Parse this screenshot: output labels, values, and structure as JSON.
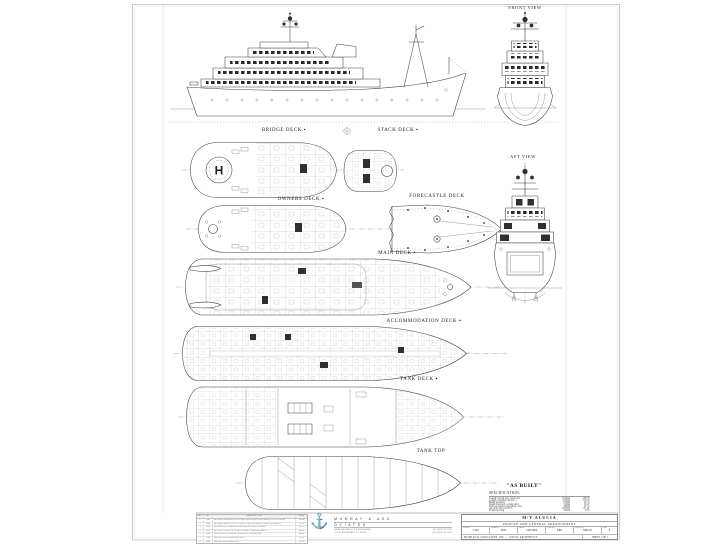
{
  "sheet": {
    "labels": {
      "front_view": "FRONT VIEW",
      "aft_view": "AFT VIEW",
      "bridge_deck": "BRIDGE DECK ▪",
      "stack_deck": "STACK DECK ▪",
      "owners_deck": "OWNERS DECK ▪",
      "forecastle_deck": "FORECASTLE DECK",
      "main_deck": "MAIN DECK ▪",
      "accommodation_deck": "ACCOMMODATION DECK ▪",
      "tank_deck": "TANK DECK ▪",
      "tank_top": "TANK TOP",
      "helipad": "H"
    },
    "status_note": "\"AS BUILT\""
  },
  "specification": {
    "title": "SPECIFICATION:",
    "rows": [
      {
        "item": "Length overall incl. davits aft",
        "metric": "55.92m",
        "imperial": "183'-6\""
      },
      {
        "item": "Length waterline (D.W.L.)",
        "metric": "51.81m",
        "imperial": "170'-0\""
      },
      {
        "item": "Beam moulded",
        "metric": "9.50m",
        "imperial": "31'-2\""
      },
      {
        "item": "Depth moulded to main deck",
        "metric": "5.03m",
        "imperial": "16'-6\""
      },
      {
        "item": "Draft at deepest operating cond.",
        "metric": "4.60m",
        "imperial": "15'-1\""
      },
      {
        "item": "Air draft above D.W.L.",
        "metric": "22.50m",
        "imperial": "73'-10\""
      },
      {
        "item": "Frame spacing",
        "metric": "0.61m",
        "imperial": "2'-0\""
      }
    ]
  },
  "title_block": {
    "vessel_name": "M/Y ALUCIA",
    "drawing_title": "PROFILE AND GENERAL ARRANGEMENT",
    "fields": [
      {
        "label": "SCALE",
        "value": "1:100"
      },
      {
        "label": "DRAWN",
        "value": "D.M."
      },
      {
        "label": "DATE",
        "value": "JAN 2004"
      },
      {
        "label": "JOB NO.",
        "value": "0401"
      },
      {
        "label": "DWG NO.",
        "value": "0401-01"
      },
      {
        "label": "REV",
        "value": "6"
      }
    ],
    "firm": "MURRAY & ASSOCIATES, INC. — NAVAL ARCHITECTS",
    "sheet": "SHEET 1 OF 1"
  },
  "company": {
    "anchor_icon": "⚓",
    "name_top": "MURRAY & ASS",
    "name_bottom": "OCIATES",
    "tagline": "NAVAL ARCHITECTS & ENGINEERS",
    "city": "FORT LAUDERDALE, FLORIDA",
    "phone": "TEL (954) 525-3720",
    "fax": "FAX (954) 525-3721"
  },
  "revisions": {
    "headers": [
      "NO.",
      "BY",
      "DESCRIPTION",
      "DATE"
    ],
    "rows": [
      [
        "6",
        "D.M.",
        "REVISED OWNERS DECK AND STACK DECK EQUIPMENT TO AS BUILT",
        "01/04"
      ],
      [
        "5",
        "D.M.",
        "REVISED MAIN DECK GALLEY AND LAZARETTE ARRANGEMENT",
        "11/03"
      ],
      [
        "4",
        "R.B.",
        "REVISED ACCOMMODATION DECK CABIN LAYOUT",
        "09/03"
      ],
      [
        "3",
        "R.B.",
        "REVISED TANK DECK MACHINERY ARRANGEMENT",
        "06/03"
      ],
      [
        "2",
        "D.M.",
        "GENERAL REVISIONS TO SURVEY CONDITION",
        "04/03"
      ],
      [
        "1",
        "D.M.",
        "ISSUED FOR OWNER REVIEW",
        "02/03"
      ],
      [
        "0",
        "D.M.",
        "ISSUED FOR APPROVAL",
        "01/03"
      ]
    ]
  }
}
